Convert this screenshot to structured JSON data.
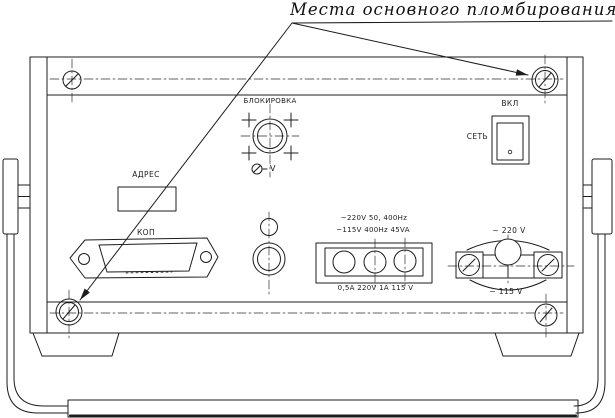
{
  "colors": {
    "ink": "#1c1c1c",
    "paper": "#ffffff"
  },
  "title": {
    "text": "Места основного пломбирования"
  },
  "panel": {
    "blocking": {
      "label": "БЛОКИРОВКА"
    },
    "adjust": {
      "label": "V"
    },
    "address": {
      "label": "АДРЕС"
    },
    "gpib": {
      "label": "КОП"
    },
    "switch": {
      "top_label": "ВКЛ",
      "side_label": "СЕТЬ"
    },
    "power": {
      "line1": "~220V 50, 400Hz",
      "line2": "~115V 400Hz 45VA",
      "rating": "0,5A 220V 1A 115 V"
    },
    "selector": {
      "top_label": "~ 220 V",
      "bottom_label": "~ 115 V"
    }
  }
}
